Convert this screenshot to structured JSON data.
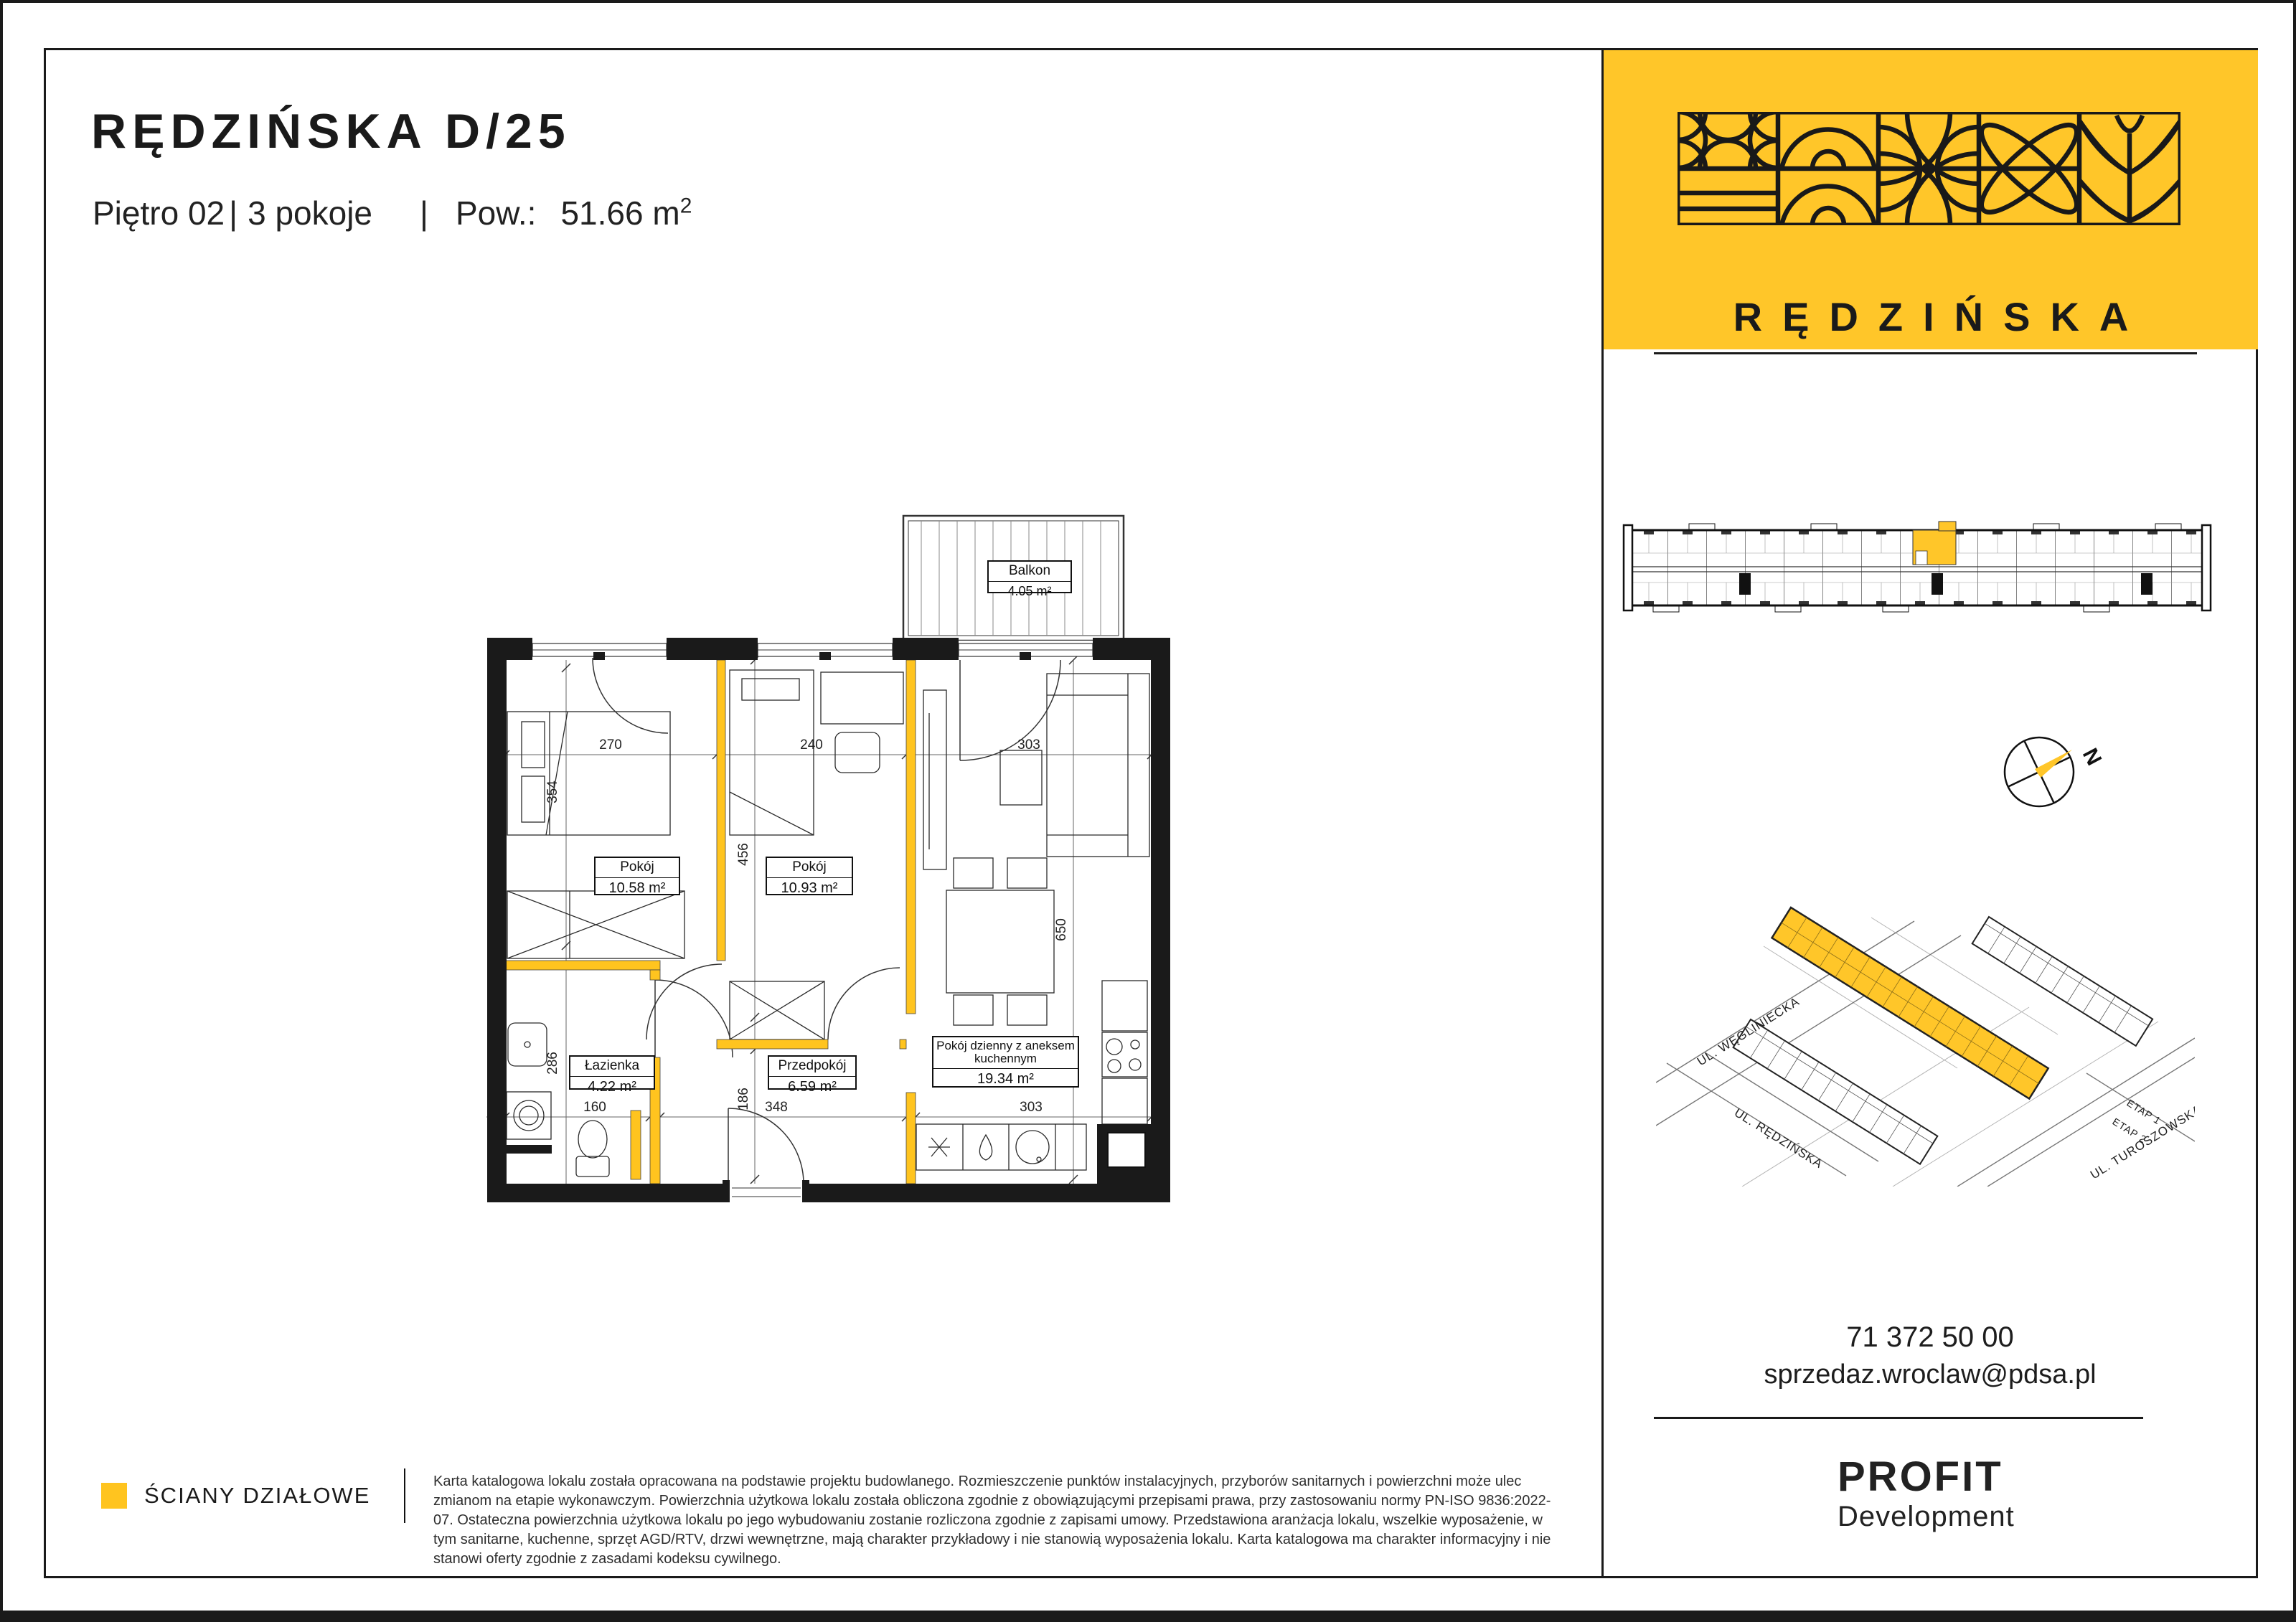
{
  "header": {
    "title": "RĘDZIŃSKA D/25",
    "floor": "Piętro 02",
    "rooms_count": "3 pokoje",
    "separator": "|",
    "area_label": "Pow.:",
    "area_value": "51.66 m",
    "area_sup": "2"
  },
  "colors": {
    "yellow": "#FFC629",
    "wall-yellow": "#FFC41F",
    "black": "#1A1A1A"
  },
  "plan": {
    "rooms": [
      {
        "name": "Pokój",
        "area": "10.58 m²"
      },
      {
        "name": "Pokój",
        "area": "10.93 m²"
      },
      {
        "name": "Łazienka",
        "area": "4.22 m²"
      },
      {
        "name": "Przedpokój",
        "area": "6.59 m²"
      },
      {
        "name": "Pokój dzienny z aneksem kuchennym",
        "area": "19.34 m²"
      },
      {
        "name": "Balkon",
        "area": "4.05 m²"
      }
    ],
    "dims": {
      "top1": "270",
      "top2": "240",
      "top3": "303",
      "left1": "354",
      "left2": "286",
      "mid1": "456",
      "mid2": "186",
      "right1": "650",
      "bot1": "160",
      "bot2": "348",
      "bot3": "303"
    }
  },
  "legend": {
    "label": "ŚCIANY DZIAŁOWE"
  },
  "disclaimer": "Karta katalogowa lokalu została opracowana na podstawie projektu budowlanego. Rozmieszczenie punktów instalacyjnych, przyborów sanitarnych i powierzchni może ulec zmianom na etapie wykonawczym. Powierzchnia użytkowa lokalu została obliczona zgodnie z obowiązującymi przepisami prawa, przy zastosowaniu normy PN-ISO 9836:2022-07. Ostateczna powierzchnia użytkowa lokalu po jego wybudowaniu zostanie rozliczona zgodnie z zapisami umowy. Przedstawiona aranżacja lokalu, wszelkie wyposażenie, w tym sanitarne, kuchenne, sprzęt AGD/RTV, drzwi wewnętrzne, mają charakter przykładowy i nie stanowią wyposażenia lokalu. Karta katalogowa ma charakter informacyjny i nie stanowi oferty zgodnie z zasadami kodeksu cywilnego.",
  "sidebar": {
    "brand": "RĘDZIŃSKA",
    "phone": "71 372 50 00",
    "email": "sprzedaz.wroclaw@pdsa.pl",
    "developer_name": "PROFIT",
    "developer_sub": "Development",
    "compass_north": "N",
    "map": {
      "street1": "UL. WĘGLINIECKA",
      "street2": "UL. RĘDZIŃSKA",
      "street3": "UL. TUROSZOWSKA",
      "etap1": "ETAP 1",
      "etap2": "ETAP 2"
    }
  }
}
